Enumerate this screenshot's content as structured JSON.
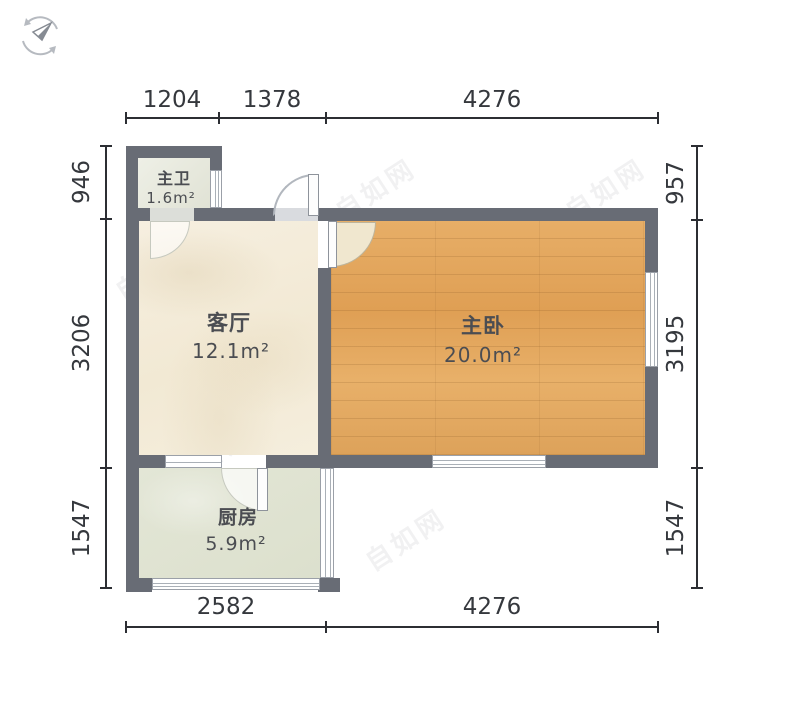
{
  "title": "户型图",
  "compass": {
    "icon": "compass-icon"
  },
  "rooms": {
    "bathroom": {
      "name": "主卫",
      "area": "1.6m²"
    },
    "living": {
      "name": "客厅",
      "area": "12.1m²"
    },
    "bedroom": {
      "name": "主卧",
      "area": "20.0m²"
    },
    "kitchen": {
      "name": "厨房",
      "area": "5.9m²"
    }
  },
  "dimensions": {
    "top": {
      "d0": "1204",
      "d1": "1378",
      "d2": "4276"
    },
    "bottom": {
      "d0": "2582",
      "d1": "4276"
    },
    "left": {
      "d0": "946",
      "d1": "3206",
      "d2": "1547"
    },
    "right": {
      "d0": "957",
      "d1": "3195",
      "d2": "1547"
    }
  },
  "watermark": {
    "text": "自如网"
  },
  "colors": {
    "wall": "#686c75",
    "living_floor": "#f4ecda",
    "bedroom_floor": "#e2a65e",
    "kitchen_floor": "#e0e3d2",
    "bathroom_floor": "#e5e7d9",
    "dimension_text": "#35383d"
  }
}
